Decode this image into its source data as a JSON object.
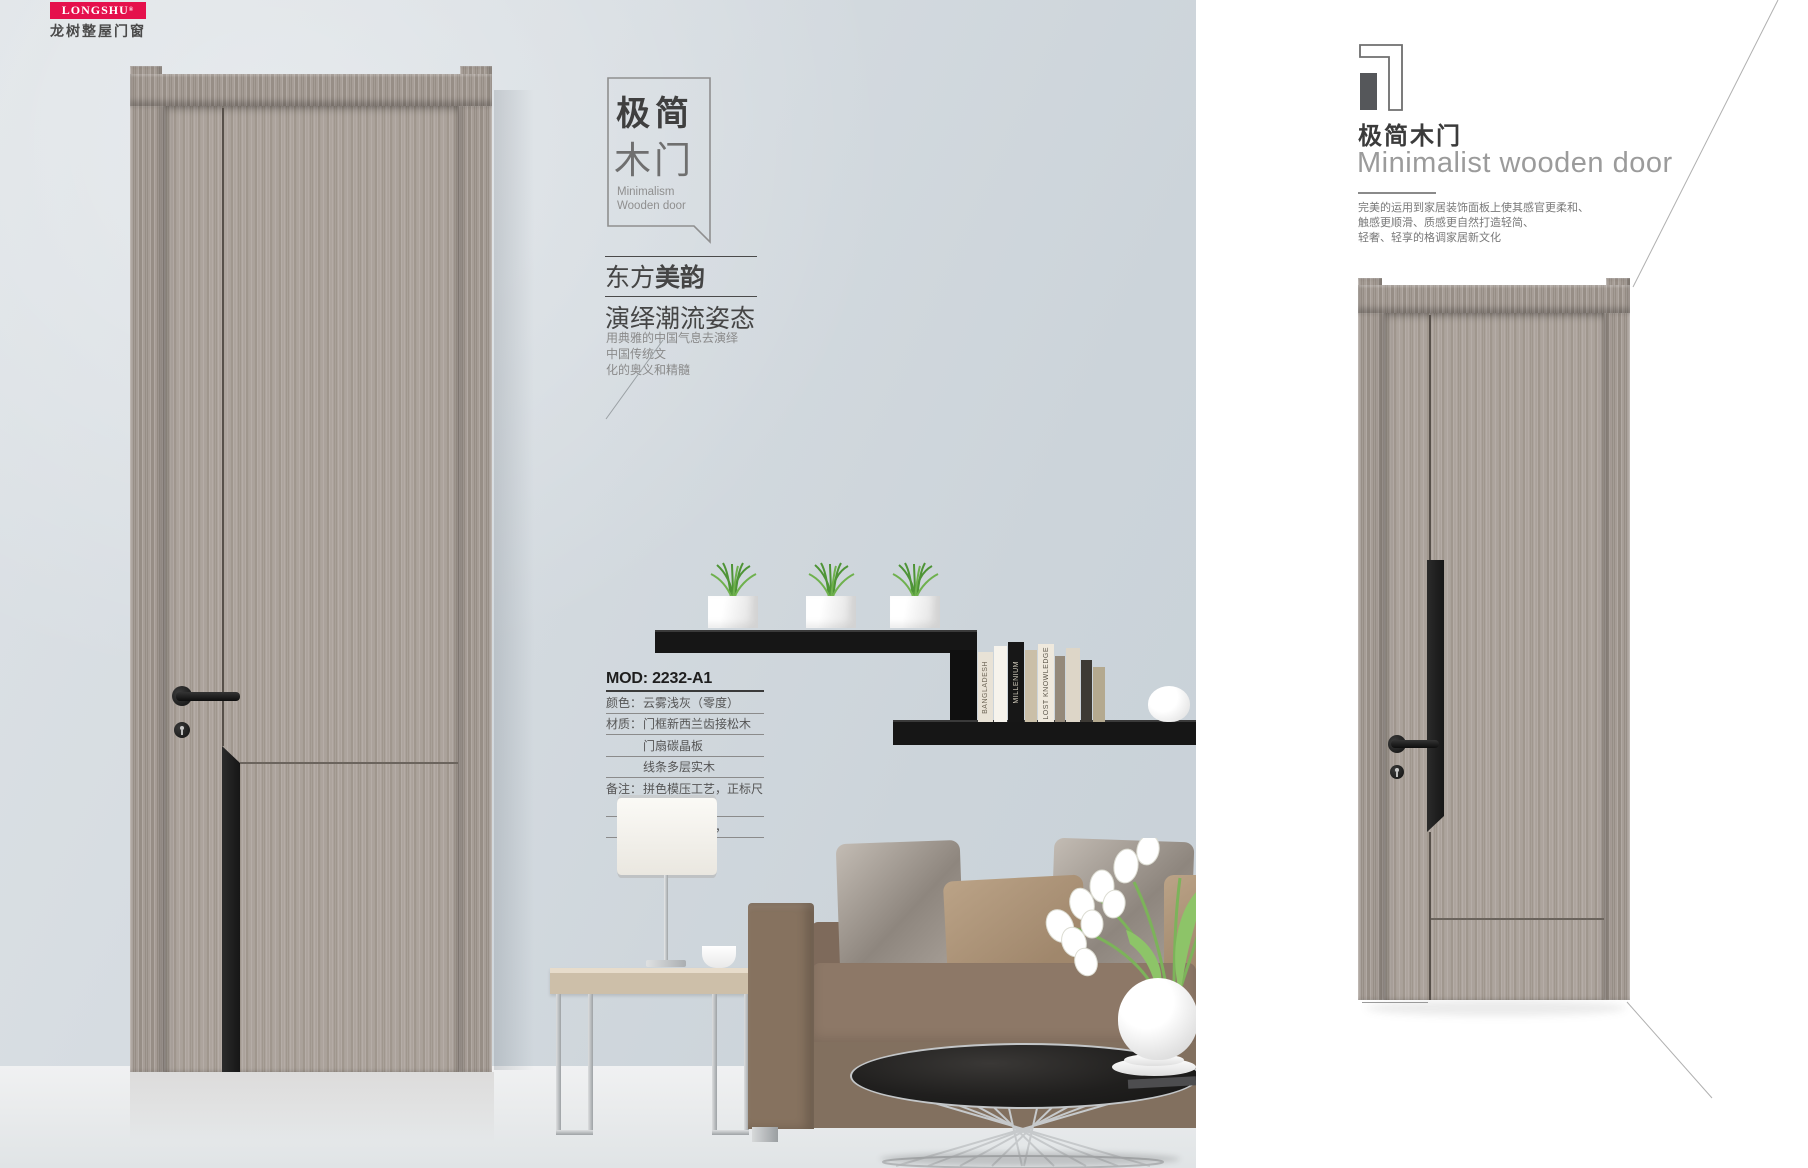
{
  "brand": {
    "logo_text": "LONGSHU",
    "logo_reg": "®",
    "logo_sub": "龙树整屋门窗",
    "brand_red": "#e5104c"
  },
  "colors": {
    "wall_blue_gray": "#d3dade",
    "door_wood": "#a79e97",
    "accent_black": "#1a1a1a",
    "heading_gray": "#3b3b3b"
  },
  "left_page": {
    "title_box": {
      "cn1": "极简",
      "cn2": "木门",
      "en1": "Minimalism",
      "en2": "Wooden door"
    },
    "slogan": {
      "line1_regular": "东方",
      "line1_bold": "美韵",
      "line2": "演绎潮流姿态"
    },
    "desc": [
      "用典雅的中国气息去演绎",
      "中国传统文",
      "化的奥义和精髓"
    ],
    "spec": {
      "model": "MOD: 2232-A1",
      "rows": [
        {
          "label": "颜色：",
          "value": "云雾浅灰（零度）"
        },
        {
          "label": "材质：",
          "value": "门框新西兰齿接松木"
        },
        {
          "label": "",
          "value": "门扇碳晶板"
        },
        {
          "label": "",
          "value": "线条多层实木"
        },
        {
          "label": "备注：",
          "value": "拼色模压工艺，正标尺寸"
        },
        {
          "label": "",
          "value": "可做静音系列，"
        }
      ]
    },
    "shelf_books": [
      "BANGLADESH",
      "MILLENIUM",
      "LOST KNOWLEDGE"
    ]
  },
  "right_page": {
    "index_number": "1",
    "heading_cn": "极简木门",
    "heading_en": "Minimalist wooden door",
    "desc": [
      "完美的运用到家居装饰面板上使其感官更柔和、",
      "触感更顺滑、质感更自然打造轻简、",
      "轻奢、轻享的格调家居新文化"
    ],
    "spec": {
      "model": "MOD: 2231-A1",
      "rows": [
        {
          "label": "颜色：",
          "value": "云雾浅灰（零度）"
        },
        {
          "label": "材质：",
          "value": "门框新西兰齿接松木"
        },
        {
          "label": "",
          "value": "门扇碳晶板"
        },
        {
          "label": "",
          "value": "线条多层实木"
        },
        {
          "label": "备注：",
          "value": "拼色模压工艺，正标尺寸"
        },
        {
          "label": "",
          "value": "可做静音系列，"
        }
      ]
    }
  }
}
